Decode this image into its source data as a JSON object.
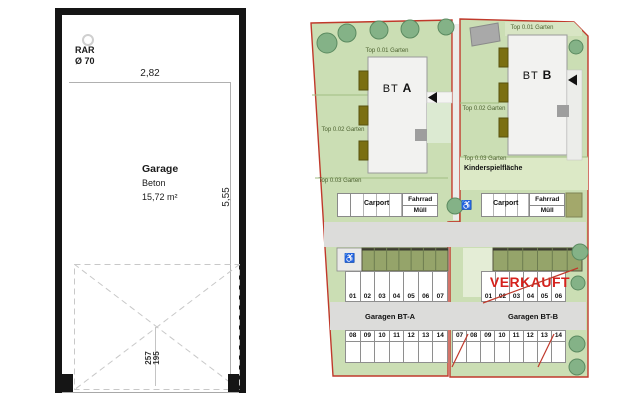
{
  "left_plan": {
    "drain_label": "RAR",
    "drain_size": "Ø 70",
    "width_dimension": "2,82",
    "depth_dimension": "5,55",
    "room_name": "Garage",
    "material": "Beton",
    "area": "15,72 m²",
    "door_dimension_1": "257",
    "door_dimension_2": "195"
  },
  "site_plan": {
    "parcel_a": {
      "garden_top": "Top 0.01 Garten",
      "garden_mid": "Top 0.02 Garten",
      "garden_bottom": "Top 0.03 Garten",
      "building_prefix": "BT",
      "building_letter": "A",
      "carport_label": "Carport",
      "bike_label": "Fahrrad",
      "waste_label": "Müll",
      "garage_title": "Garagen BT-A",
      "garage_row_top": [
        "01",
        "02",
        "03",
        "04",
        "05",
        "06",
        "07"
      ],
      "garage_row_bottom": [
        "08",
        "09",
        "10",
        "11",
        "12",
        "13",
        "14"
      ],
      "accessible_glyph": "♿"
    },
    "parcel_b": {
      "garden_top": "Top 0.01 Garten",
      "garden_mid": "Top 0.02 Garten",
      "garden_bottom": "Top 0.03 Garten",
      "playground_label": "Kinderspielfläche",
      "building_prefix": "BT",
      "building_letter": "B",
      "carport_label": "Carport",
      "bike_label": "Fahrrad",
      "waste_label": "Müll",
      "garage_title": "Garagen BT-B",
      "sold_label": "VERKAUFT",
      "garage_row_top": [
        "01",
        "02",
        "03",
        "04",
        "05",
        "06"
      ],
      "garage_row_bottom": [
        "07",
        "08",
        "09",
        "10",
        "11",
        "12",
        "13",
        "14"
      ],
      "slashed_stalls": [
        "07",
        "13"
      ],
      "accessible_glyph": "♿"
    },
    "colors": {
      "boundary_red": "#c0392b",
      "sold_red": "#d5211c",
      "garden_green": "#cbdeb4",
      "roof_olive": "#95a46a",
      "balcony_olive": "#7b6f12",
      "tree_green": "#84b287"
    }
  }
}
